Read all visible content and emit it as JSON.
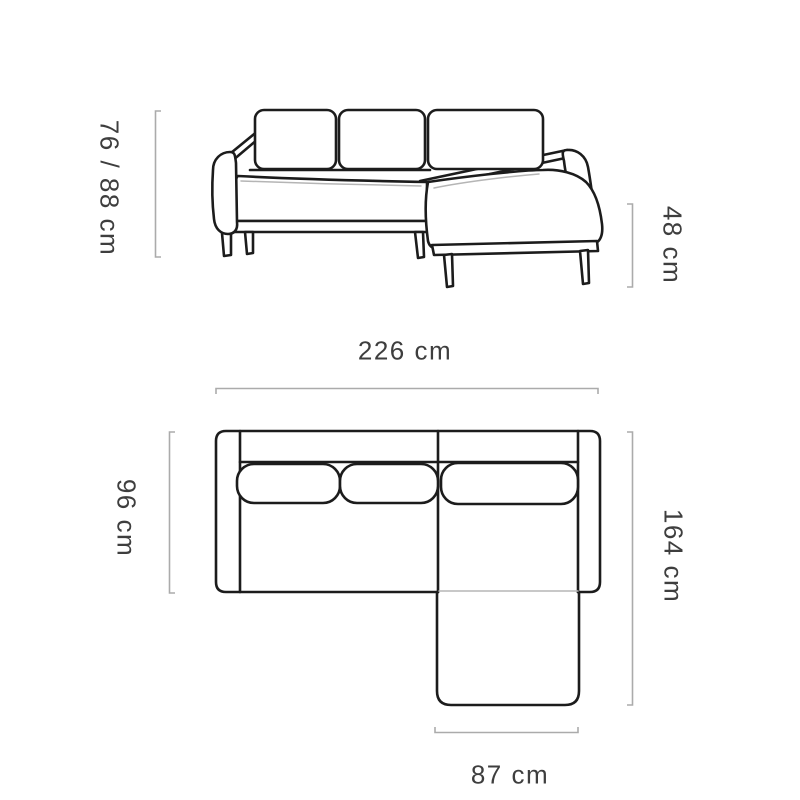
{
  "diagram": {
    "kind": "corner-sofa dimension drawing",
    "views": {
      "front": {
        "labels": {
          "overall_height": "76 / 88 cm",
          "seat_height": "48 cm"
        }
      },
      "top": {
        "labels": {
          "overall_width": "226 cm",
          "sofa_depth": "96 cm",
          "chaise_depth": "164 cm",
          "chaise_width": "87 cm"
        }
      }
    },
    "colors": {
      "outline": "#1c1c1c",
      "seam_line": "#b5b5b5",
      "dimension_line": "#ababab",
      "label_text": "#3e3e3e",
      "background": "#ffffff"
    }
  }
}
